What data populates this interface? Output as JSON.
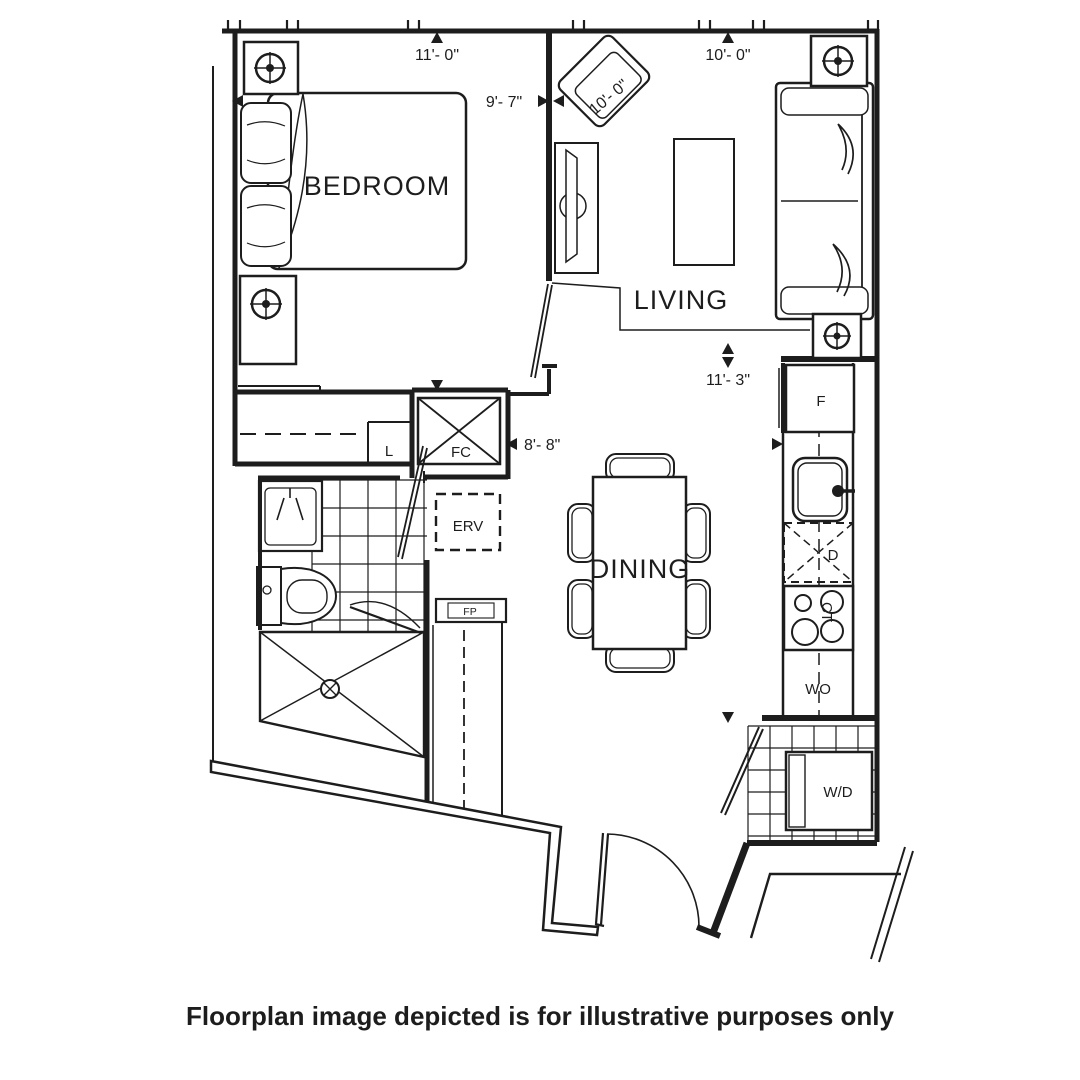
{
  "floorplan": {
    "rooms": {
      "bedroom": "BEDROOM",
      "living": "LIVING",
      "dining": "DINING"
    },
    "fixtures": {
      "linen": "L",
      "fan_coil": "FC",
      "erv": "ERV",
      "fp": "FP",
      "fridge": "F",
      "dishwasher": "D",
      "cooktop": "CT",
      "wall_oven": "WO",
      "washer_dryer": "W/D"
    },
    "dimensions": {
      "bedroom_width": "11'- 0\"",
      "bedroom_depth": "9'- 7\"",
      "living_width": "10'- 0\"",
      "living_diagonal": "10'- 0\"",
      "kitchen_run": "11'- 3\"",
      "dining_width": "8'- 8\""
    },
    "colors": {
      "line": "#1d1d1d",
      "background": "#ffffff"
    }
  },
  "caption": {
    "text": "Floorplan image depicted is for illustrative purposes only"
  }
}
